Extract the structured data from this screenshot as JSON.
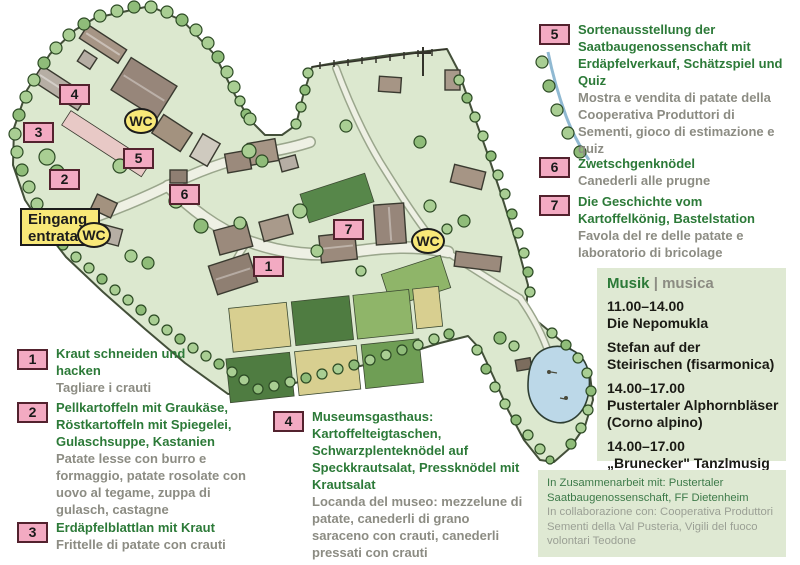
{
  "colors": {
    "marker_pink": "#f3aac2",
    "marker_border": "#53222e",
    "wc_yellow": "#f8e878",
    "text_green": "#2c7a38",
    "text_gray": "#8c8c83",
    "panel_bg": "#dfe9d3"
  },
  "map": {
    "entrance_label_line1": "Eingang",
    "entrance_label_line2": "entrata",
    "wc_label": "WC",
    "markers": {
      "m1": "1",
      "m2": "2",
      "m3": "3",
      "m4": "4",
      "m5": "5",
      "m6": "6",
      "m7": "7"
    }
  },
  "legend": {
    "items": [
      {
        "num": "1",
        "de": "Kraut schneiden und hacken",
        "it": "Tagliare i crauti"
      },
      {
        "num": "2",
        "de": "Pellkartoffeln mit Graukäse, Röstkartoffeln mit Spiegelei, Gulaschsuppe, Kastanien",
        "it": "Patate lesse con burro e formaggio, patate rosolate con uovo al tegame, zuppa di gulasch, castagne"
      },
      {
        "num": "3",
        "de": "Erdäpfelblattlan mit Kraut",
        "it": "Frittelle di patate con crauti"
      },
      {
        "num": "4",
        "de": "Museumsgasthaus: Kartoffelteigtaschen, Schwarzplenteknödel auf Speckkrautsalat, Pressknödel mit Krautsalat",
        "it": "Locanda del museo: mezzelune di patate, canederli di grano saraceno con crauti, canederli pressati con crauti"
      },
      {
        "num": "5",
        "de": "Sortenausstellung der Saatbaugenossenschaft mit Erdäpfelverkauf, Schätzspiel und Quiz",
        "it": "Mostra e vendita di patate della Cooperativa Produttori di Sementi, gioco di estimazione e quiz"
      },
      {
        "num": "6",
        "de": "Zwetschgenknödel",
        "it": "Canederli alle prugne"
      },
      {
        "num": "7",
        "de": "Die Geschichte vom Kartoffelkönig, Bastelstation",
        "it": "Favola del re delle patate e laboratorio di bricolage"
      }
    ]
  },
  "music": {
    "title_de": "Musik",
    "separator": "|",
    "title_it": "musica",
    "entries": [
      {
        "time": "11.00–14.00",
        "name": "Die Nepomukla"
      },
      {
        "name": "Stefan auf der Steirischen (fisarmonica)"
      },
      {
        "time": "14.00–17.00",
        "name": "Pustertaler Alphornbläser (Corno alpino)"
      },
      {
        "time": "14.00–17.00",
        "name": "„Brunecker\" Tanzlmusig"
      }
    ]
  },
  "partners": {
    "de": "In Zusammenarbeit mit: Pustertaler Saatbaugenossenschaft, FF Dietenheim",
    "it": "In collaborazione con: Cooperativa Produttori Sementi della Val Pusteria, Vigili del fuoco volontari Teodone"
  }
}
